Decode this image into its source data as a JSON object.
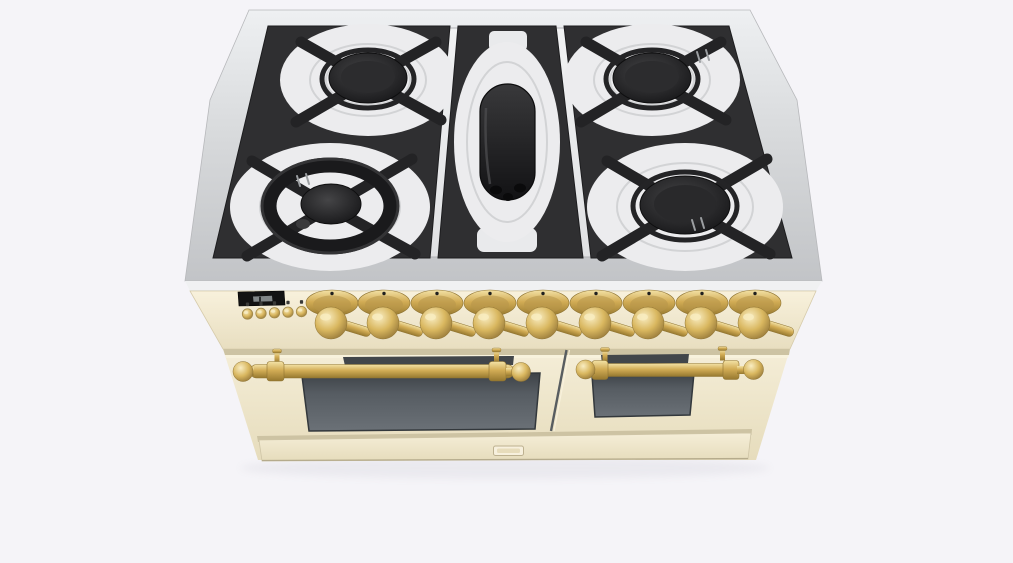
{
  "scene": {
    "type": "3d-product-render",
    "subject": "freestanding dual-fuel range cooker, antique white body with brass trim",
    "view": "front-top perspective",
    "background": "plain light studio backdrop"
  },
  "colors": {
    "background": "#f5f4f8",
    "steel_rim": "#d8d9dc",
    "steel_face": "#c6c8cb",
    "steel_lip": "#f0f1f2",
    "cooktop_surface": "#ececee",
    "grate_black": "#2f2f31",
    "burner_cap": "#1c1c1e",
    "body_cream": "#f1e9cf",
    "body_cream_shadow": "#cdc3a3",
    "brass": "#d4b166",
    "brass_dark": "#97793a",
    "brass_light": "#f6e7b4",
    "oven_window": "#565c62",
    "display_bg": "#131313",
    "display_segment": "#8f9596",
    "divider": "#585d60"
  },
  "cooktop": {
    "grate_modules": 3,
    "burners": [
      {
        "id": "left-rear",
        "style": "round burner, black cap"
      },
      {
        "id": "left-front",
        "style": "large dual-ring wok burner, black"
      },
      {
        "id": "center",
        "style": "oval griddle burner, black"
      },
      {
        "id": "right-rear",
        "style": "round burner, black cap"
      },
      {
        "id": "right-front",
        "style": "round burner, black cap"
      }
    ]
  },
  "control_panel": {
    "display": {
      "kind": "small digital clock window",
      "text": ""
    },
    "small_buttons": 5,
    "knobs": 9,
    "knob_finish": "brass"
  },
  "ovens": {
    "doors": [
      {
        "id": "left",
        "handle": "brass rail with ball finials",
        "window": true
      },
      {
        "id": "right",
        "handle": "brass rail with ball finials",
        "window": true
      }
    ],
    "drawer": {
      "badge": true
    }
  }
}
